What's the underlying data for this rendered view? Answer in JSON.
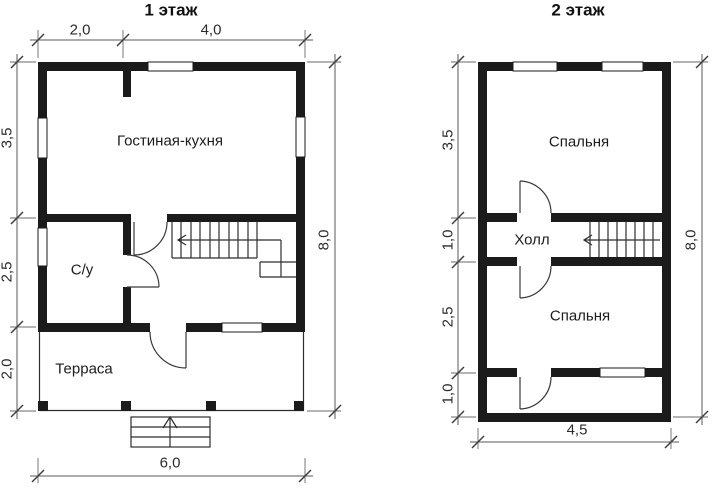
{
  "document": {
    "type": "house floor plan, two storeys",
    "colors": {
      "background": "#ffffff",
      "walls": "#1b1b1b",
      "thin_lines": "#2e2e2e",
      "dimension_lines": "#5a5a5a"
    }
  },
  "floor1": {
    "title": "1 этаж",
    "room_labels": {
      "living_kitchen": "Гостиная-кухня",
      "bathroom": "С/у",
      "terrace": "Терраса"
    },
    "dimensions": {
      "top": [
        "2,0",
        "4,0"
      ],
      "left": [
        "3,5",
        "2,5",
        "2,0"
      ],
      "right": "8,0",
      "bottom": "6,0"
    }
  },
  "floor2": {
    "title": "2 этаж",
    "room_labels": {
      "bedroom_top": "Спальня",
      "hall": "Холл",
      "bedroom_bottom": "Спальня"
    },
    "dimensions": {
      "left": [
        "3,5",
        "1,0",
        "2,5",
        "1,0"
      ],
      "right": "8,0",
      "bottom": "4,5"
    }
  }
}
